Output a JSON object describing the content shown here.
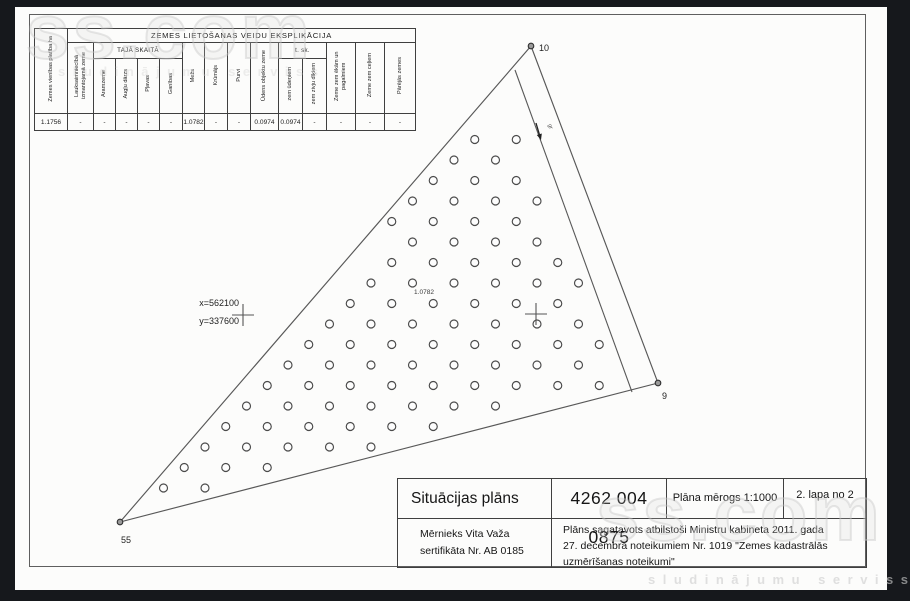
{
  "watermark": {
    "brand": "ss.com",
    "tagline": "sludinājumu serviss"
  },
  "explication": {
    "title": "ZEMES LIETOŠANAS VEIDU EKSPLIKĀCIJA",
    "group_headers": {
      "taja_skaita": "TAJĀ SKAITĀ",
      "t_sk": "t. sk."
    },
    "columns": [
      {
        "label": "Zemes vienības platība ha",
        "value": "1.1756"
      },
      {
        "label": "Lauksaimniecībā izmantojamā zeme",
        "value": "-"
      },
      {
        "label": "Aramzeme",
        "value": "-"
      },
      {
        "label": "Augļu dārzs",
        "value": "-"
      },
      {
        "label": "Pļavas",
        "value": "-"
      },
      {
        "label": "Ganības",
        "value": "-"
      },
      {
        "label": "Mežs",
        "value": "1.0782"
      },
      {
        "label": "Krūmājs",
        "value": "-"
      },
      {
        "label": "Purvi",
        "value": "-"
      },
      {
        "label": "Ūdens objektu zeme",
        "value": "0.0974"
      },
      {
        "label": "zem ūdeņiem",
        "value": "0.0974"
      },
      {
        "label": "zem zivju dīķiem",
        "value": "-"
      },
      {
        "label": "Zeme zem ēkām un pagalmiem",
        "value": "-"
      },
      {
        "label": "Zeme zem ceļiem",
        "value": "-"
      },
      {
        "label": "Pārējās zemes",
        "value": "-"
      }
    ]
  },
  "plan": {
    "survey_points": [
      {
        "id": "10",
        "x": 531,
        "y": 46,
        "label_x": 539,
        "label_y": 51,
        "anchor": "start"
      },
      {
        "id": "9",
        "x": 658,
        "y": 383,
        "label_x": 662,
        "label_y": 399,
        "anchor": "start"
      },
      {
        "id": "55",
        "x": 120,
        "y": 522,
        "label_x": 126,
        "label_y": 543,
        "anchor": "middle"
      }
    ],
    "boundary": [
      [
        531,
        46
      ],
      [
        658,
        383
      ],
      [
        120,
        522
      ]
    ],
    "ditch_line": [
      [
        515,
        70
      ],
      [
        632,
        392
      ]
    ],
    "grid_crosses": [
      [
        243,
        315
      ],
      [
        536,
        314
      ]
    ],
    "coordinate_label": {
      "x_text": "x=562100",
      "y_text": "y=337600",
      "anchor_x": 239,
      "x_baseline": 306,
      "y_baseline": 324
    },
    "area_label": {
      "text": "1.0782",
      "x": 424,
      "y": 294
    },
    "flow_arrow": {
      "label": "gr",
      "tail": [
        536,
        123
      ],
      "tip": [
        541,
        140
      ],
      "label_x": 549,
      "label_y": 127
    },
    "forest_dots": {
      "x0": 122,
      "y0": 139.5,
      "x_spacing": 41.5,
      "y_spacing": 20.5,
      "row_offset": 20.75,
      "radius": 4,
      "edge_inset": 8,
      "ditch_margin": 12
    },
    "line_color": "#585858",
    "text_color": "#222222"
  },
  "title_block": {
    "doc_type": "Situācijas plāns",
    "cadastre_number": "4262 004 0875",
    "scale": "Plāna mērogs 1:1000",
    "page": "2. lapa no 2",
    "surveyor_lines": [
      "Mērnieks Vita Važa",
      "sertifikāta Nr. AB 0185"
    ],
    "note_lines": [
      "Plāns sagatavots atbilstoši Ministru kabineta 2011. gada",
      "27. decembra noteikumiem Nr. 1019 \"Zemes kadastrālās",
      "uzmērīšanas noteikumi\""
    ]
  }
}
